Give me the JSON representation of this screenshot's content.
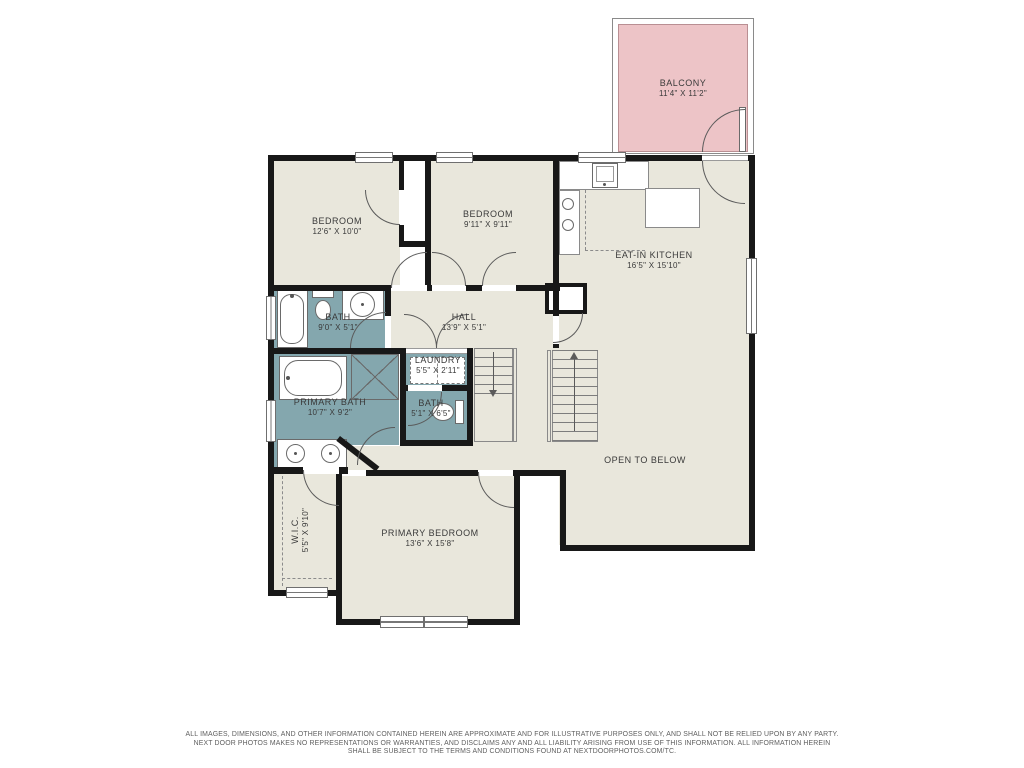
{
  "colors": {
    "room_fill": "#e9e7dc",
    "wet_room_fill": "#84a7ae",
    "balcony_fill": "#edc4c7",
    "wall": "#181818",
    "line": "#5a5a5a",
    "text": "#3a3a3a"
  },
  "rooms": {
    "balcony": {
      "name": "BALCONY",
      "dims": "11'4\" X 11'2\""
    },
    "bedroom1": {
      "name": "BEDROOM",
      "dims": "12'6\" X 10'0\""
    },
    "bedroom2": {
      "name": "BEDROOM",
      "dims": "9'11\" X 9'11\""
    },
    "kitchen": {
      "name": "EAT-IN KITCHEN",
      "dims": "16'5\" X 15'10\""
    },
    "bath1": {
      "name": "BATH",
      "dims": "9'0\" X 5'1\""
    },
    "hall": {
      "name": "HALL",
      "dims": "13'9\" X 5'1\""
    },
    "laundry": {
      "name": "LAUNDRY",
      "dims": "5'5\" X 2'11\""
    },
    "primary_bath": {
      "name": "PRIMARY BATH",
      "dims": "10'7\" X 9'2\""
    },
    "bath2": {
      "name": "BATH",
      "dims": "5'1\" X 6'5\""
    },
    "open_below": {
      "name": "OPEN TO BELOW",
      "dims": ""
    },
    "wic": {
      "name": "W.I.C.",
      "dims": "5'5\" X 9'10\""
    },
    "primary_bedroom": {
      "name": "PRIMARY BEDROOM",
      "dims": "13'6\" X 15'8\""
    }
  },
  "footer": {
    "line1": "ALL IMAGES, DIMENSIONS, AND OTHER INFORMATION CONTAINED HEREIN ARE APPROXIMATE AND FOR ILLUSTRATIVE PURPOSES ONLY, AND SHALL NOT BE RELIED UPON BY ANY PARTY.",
    "line2": "NEXT DOOR PHOTOS MAKES NO REPRESENTATIONS OR WARRANTIES, AND DISCLAIMS ANY AND ALL LIABILITY ARISING FROM USE OF THIS INFORMATION. ALL INFORMATION HEREIN",
    "line3": "SHALL BE SUBJECT TO THE TERMS AND CONDITIONS FOUND AT NEXTDOORPHOTOS.COM/TC."
  }
}
